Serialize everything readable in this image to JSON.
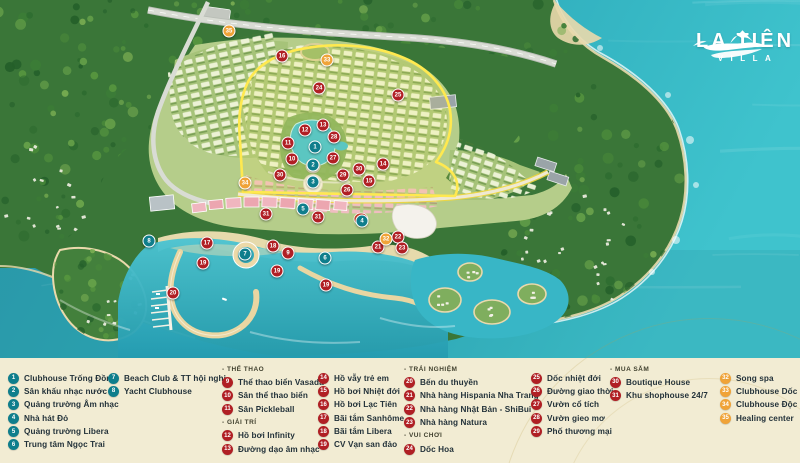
{
  "logo": {
    "title": "LA TIÊN",
    "subtitle": "VILLA"
  },
  "colors": {
    "teal": "#0f7e8c",
    "red": "#b01f24",
    "orange": "#f0a338",
    "sea": "#2aa0b1",
    "legend_bg": "#f2ecd3",
    "highlight": "#ffe94f"
  },
  "legend": {
    "section_headers": [
      "- THỂ THAO",
      "- GIẢI TRÍ",
      "- TRẢI NGHIỆM",
      "- VUI CHƠI",
      "- MUA SẮM"
    ],
    "columns": [
      {
        "x": 8,
        "y": 372,
        "rows": [
          {
            "type": "item",
            "n": "1",
            "c": "teal",
            "label": "Clubhouse Trống Đồng"
          },
          {
            "type": "item",
            "n": "2",
            "c": "teal",
            "label": "Sân khấu nhạc nước"
          },
          {
            "type": "item",
            "n": "3",
            "c": "teal",
            "label": "Quảng trường Âm nhạc"
          },
          {
            "type": "item",
            "n": "4",
            "c": "teal",
            "label": "Nhà hát Đỏ"
          },
          {
            "type": "item",
            "n": "5",
            "c": "teal",
            "label": "Quảng trường Libera"
          },
          {
            "type": "item",
            "n": "6",
            "c": "teal",
            "label": "Trung tâm Ngọc Trai"
          }
        ]
      },
      {
        "x": 108,
        "y": 372,
        "rows": [
          {
            "type": "item",
            "n": "7",
            "c": "teal",
            "label": "Beach Club & TT hội nghị"
          },
          {
            "type": "item",
            "n": "8",
            "c": "teal",
            "label": "Yacht Clubhouse"
          }
        ]
      },
      {
        "x": 222,
        "y": 363,
        "rows": [
          {
            "type": "header",
            "label": "- THỂ THAO"
          },
          {
            "type": "item",
            "n": "9",
            "c": "red",
            "label": "Thể thao biển Vasada"
          },
          {
            "type": "item",
            "n": "10",
            "c": "red",
            "label": "Sân thể thao biển"
          },
          {
            "type": "item",
            "n": "11",
            "c": "red",
            "label": "Sân Pickleball"
          },
          {
            "type": "header",
            "label": "- GIẢI TRÍ"
          },
          {
            "type": "item",
            "n": "12",
            "c": "red",
            "label": "Hồ bơi Infinity"
          },
          {
            "type": "item",
            "n": "13",
            "c": "red",
            "label": "Đường dạo âm nhạc"
          }
        ]
      },
      {
        "x": 318,
        "y": 372,
        "rows": [
          {
            "type": "item",
            "n": "14",
            "c": "red",
            "label": "Hồ vẫy trẻ em"
          },
          {
            "type": "item",
            "n": "15",
            "c": "red",
            "label": "Hồ bơi Nhiệt đới"
          },
          {
            "type": "item",
            "n": "16",
            "c": "red",
            "label": "Hồ bơi Lạc Tiên"
          },
          {
            "type": "item",
            "n": "17",
            "c": "red",
            "label": "Bãi tắm Sanhôme"
          },
          {
            "type": "item",
            "n": "18",
            "c": "red",
            "label": "Bãi tắm Libera"
          },
          {
            "type": "item",
            "n": "19",
            "c": "red",
            "label": "CV Vạn san đảo"
          }
        ]
      },
      {
        "x": 404,
        "y": 363,
        "rows": [
          {
            "type": "header",
            "label": "- TRẢI NGHIỆM"
          },
          {
            "type": "item",
            "n": "20",
            "c": "red",
            "label": "Bến du thuyền"
          },
          {
            "type": "item",
            "n": "21",
            "c": "red",
            "label": "Nhà hàng Hispania Nha Trang"
          },
          {
            "type": "item",
            "n": "22",
            "c": "red",
            "label": "Nhà hàng Nhật Bản - ShiBui"
          },
          {
            "type": "item",
            "n": "23",
            "c": "red",
            "label": "Nhà hàng Natura"
          },
          {
            "type": "header",
            "label": "- VUI CHƠI"
          },
          {
            "type": "item",
            "n": "24",
            "c": "red",
            "label": "Dốc Hoa"
          }
        ]
      },
      {
        "x": 531,
        "y": 372,
        "rows": [
          {
            "type": "item",
            "n": "25",
            "c": "red",
            "label": "Dốc nhiệt đới"
          },
          {
            "type": "item",
            "n": "26",
            "c": "red",
            "label": "Đường giao thời"
          },
          {
            "type": "item",
            "n": "27",
            "c": "red",
            "label": "Vườn cổ tích"
          },
          {
            "type": "item",
            "n": "28",
            "c": "red",
            "label": "Vườn gieo mơ"
          },
          {
            "type": "item",
            "n": "29",
            "c": "red",
            "label": "Phố thương mại"
          }
        ]
      },
      {
        "x": 610,
        "y": 363,
        "rows": [
          {
            "type": "header",
            "label": "- MUA SẮM"
          },
          {
            "type": "item",
            "n": "30",
            "c": "red",
            "label": "Boutique House"
          },
          {
            "type": "item",
            "n": "31",
            "c": "red",
            "label": "Khu shophouse 24/7"
          }
        ]
      },
      {
        "x": 720,
        "y": 372,
        "rows": [
          {
            "type": "item",
            "n": "32",
            "c": "orange",
            "label": "Song spa"
          },
          {
            "type": "item",
            "n": "33",
            "c": "orange",
            "label": "Clubhouse Dốc hoa"
          },
          {
            "type": "item",
            "n": "34",
            "c": "orange",
            "label": "Clubhouse Độc lập"
          },
          {
            "type": "item",
            "n": "35",
            "c": "orange",
            "label": "Healing center"
          }
        ]
      }
    ]
  },
  "map": {
    "markers": [
      {
        "n": "1",
        "c": "teal",
        "x": 315,
        "y": 147
      },
      {
        "n": "2",
        "c": "teal",
        "x": 313,
        "y": 165
      },
      {
        "n": "3",
        "c": "teal",
        "x": 313,
        "y": 182
      },
      {
        "n": "4",
        "c": "teal",
        "x": 362,
        "y": 221
      },
      {
        "n": "5",
        "c": "teal",
        "x": 303,
        "y": 209
      },
      {
        "n": "6",
        "c": "teal",
        "x": 325,
        "y": 258
      },
      {
        "n": "7",
        "c": "teal",
        "x": 245,
        "y": 254
      },
      {
        "n": "8",
        "c": "teal",
        "x": 149,
        "y": 241
      },
      {
        "n": "9",
        "c": "red",
        "x": 288,
        "y": 253
      },
      {
        "n": "10",
        "c": "red",
        "x": 292,
        "y": 159
      },
      {
        "n": "11",
        "c": "red",
        "x": 288,
        "y": 143
      },
      {
        "n": "12",
        "c": "red",
        "x": 305,
        "y": 130
      },
      {
        "n": "13",
        "c": "red",
        "x": 323,
        "y": 125
      },
      {
        "n": "14",
        "c": "red",
        "x": 383,
        "y": 164
      },
      {
        "n": "15",
        "c": "red",
        "x": 369,
        "y": 181
      },
      {
        "n": "16",
        "c": "red",
        "x": 282,
        "y": 56
      },
      {
        "n": "17",
        "c": "red",
        "x": 207,
        "y": 243
      },
      {
        "n": "18",
        "c": "red",
        "x": 273,
        "y": 246
      },
      {
        "n": "19",
        "c": "red",
        "x": 203,
        "y": 263
      },
      {
        "n": "19",
        "c": "red",
        "x": 277,
        "y": 271
      },
      {
        "n": "19",
        "c": "red",
        "x": 326,
        "y": 285
      },
      {
        "n": "20",
        "c": "red",
        "x": 173,
        "y": 293
      },
      {
        "n": "21",
        "c": "red",
        "x": 378,
        "y": 247
      },
      {
        "n": "22",
        "c": "red",
        "x": 398,
        "y": 237
      },
      {
        "n": "23",
        "c": "red",
        "x": 402,
        "y": 248
      },
      {
        "n": "24",
        "c": "red",
        "x": 319,
        "y": 88
      },
      {
        "n": "25",
        "c": "red",
        "x": 398,
        "y": 95
      },
      {
        "n": "26",
        "c": "red",
        "x": 347,
        "y": 190
      },
      {
        "n": "27",
        "c": "red",
        "x": 333,
        "y": 158
      },
      {
        "n": "28",
        "c": "red",
        "x": 334,
        "y": 137
      },
      {
        "n": "29",
        "c": "red",
        "x": 343,
        "y": 175
      },
      {
        "n": "30",
        "c": "red",
        "x": 280,
        "y": 175
      },
      {
        "n": "30",
        "c": "red",
        "x": 359,
        "y": 169
      },
      {
        "n": "31",
        "c": "red",
        "x": 266,
        "y": 214
      },
      {
        "n": "31",
        "c": "red",
        "x": 318,
        "y": 217
      },
      {
        "n": "32",
        "c": "orange",
        "x": 386,
        "y": 239
      },
      {
        "n": "33",
        "c": "orange",
        "x": 327,
        "y": 60
      },
      {
        "n": "34",
        "c": "orange",
        "x": 245,
        "y": 183
      },
      {
        "n": "35",
        "c": "orange",
        "x": 229,
        "y": 31
      }
    ]
  }
}
